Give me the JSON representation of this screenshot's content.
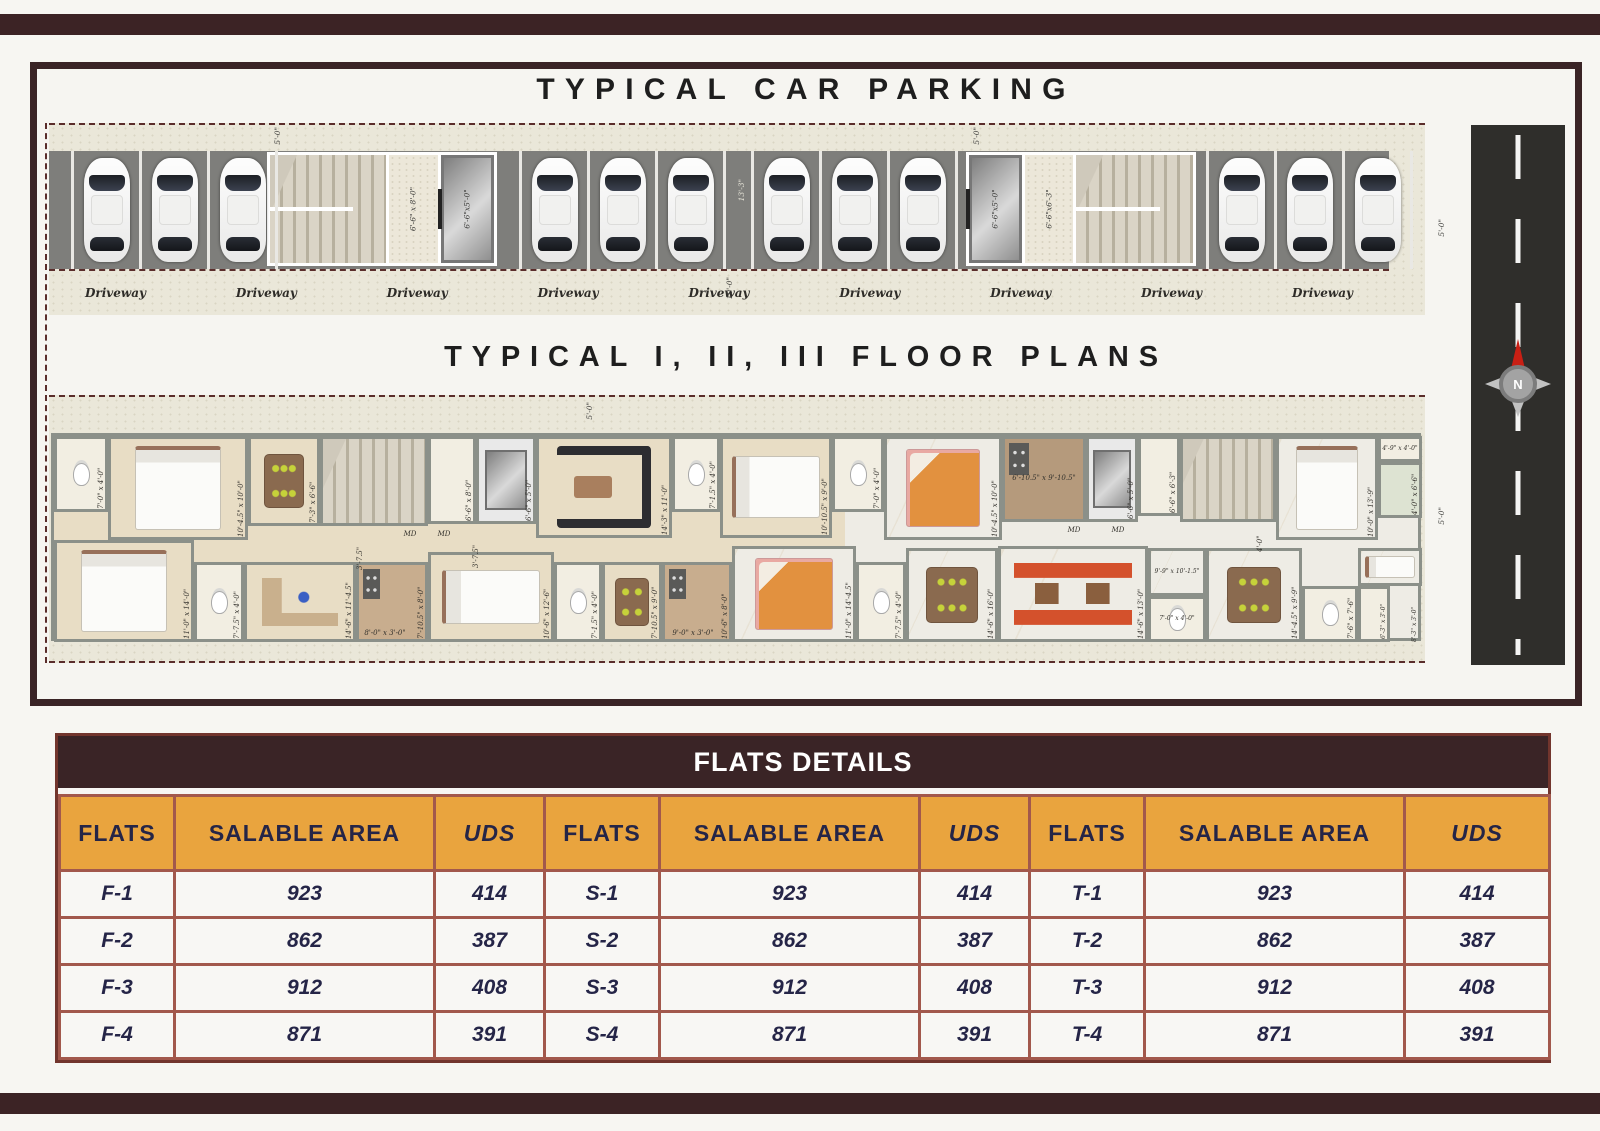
{
  "sheet": {
    "parking_title": "TYPICAL CAR PARKING",
    "floors_title": "TYPICAL I, II, III FLOOR PLANS"
  },
  "parking": {
    "driveway_labels": [
      "Driveway",
      "Driveway",
      "Driveway",
      "Driveway",
      "Driveway",
      "Driveway",
      "Driveway",
      "Driveway",
      "Driveway"
    ],
    "car_groups": [
      3,
      3,
      3,
      3
    ],
    "gap_dim": "13'-3\"",
    "driveway_dim": "10'-0\"",
    "side_dim": "5'-0\"",
    "block_a": {
      "top_dim": "5'-0\"",
      "lobby": "6'-6\" x 8'-0\"",
      "lift": "6'-6\"x5'-0\""
    },
    "block_b": {
      "top_dim": "5'-0\"",
      "lobby": "6'-6\"x6'-3\"",
      "lift": "6'-6\"x5'-0\""
    }
  },
  "floorplan": {
    "top_dim": "5'-0\"",
    "side_dim": "5'-0\"",
    "rooms": [
      {
        "n": "bath",
        "l": "7'-0\" x 4'-0\"",
        "x": 0,
        "y": 0,
        "w": 54,
        "h": 76,
        "r": 1,
        "f": "wc",
        "b": "bath"
      },
      {
        "n": "bedroom",
        "l": "10'-4.5\" x 10'-0\"",
        "x": 54,
        "y": 0,
        "w": 140,
        "h": 104,
        "r": 1,
        "f": "bedv",
        "b": "wood"
      },
      {
        "n": "dining",
        "l": "7'-3\" x 6'-6\"",
        "x": 194,
        "y": 0,
        "w": 72,
        "h": 90,
        "r": 1,
        "f": "table6",
        "b": "wood"
      },
      {
        "n": "staircase",
        "x": 266,
        "y": 0,
        "w": 108,
        "h": 90,
        "f": "stair",
        "b": "stair"
      },
      {
        "n": "lift-lobby",
        "l": "6'-6\" x 8'-0\"",
        "x": 374,
        "y": 0,
        "w": 48,
        "h": 88,
        "r": 1,
        "b": "bath"
      },
      {
        "n": "lift",
        "l": "6'-6\" x 5'-0\"",
        "x": 422,
        "y": 0,
        "w": 60,
        "h": 88,
        "r": 1,
        "f": "lift",
        "b": "lift"
      },
      {
        "n": "living",
        "l": "14'-3\" x 11'-0\"",
        "x": 482,
        "y": 0,
        "w": 136,
        "h": 102,
        "r": 1,
        "f": "sofad",
        "b": "wood"
      },
      {
        "n": "bath",
        "l": "7'-1.5\" x 4'-0\"",
        "x": 618,
        "y": 0,
        "w": 48,
        "h": 76,
        "r": 1,
        "f": "wc",
        "b": "bath"
      },
      {
        "n": "bedroom",
        "l": "10'-10.5\" x 9'-0\"",
        "x": 666,
        "y": 0,
        "w": 112,
        "h": 102,
        "r": 1,
        "f": "bedh",
        "b": "wood"
      },
      {
        "n": "bath",
        "l": "7'-0\" x 4'-0\"",
        "x": 778,
        "y": 0,
        "w": 52,
        "h": 76,
        "r": 1,
        "f": "wc",
        "b": "bath"
      },
      {
        "n": "bedroom",
        "l": "10'-4.5\" x 10'-0\"",
        "x": 830,
        "y": 0,
        "w": 118,
        "h": 104,
        "r": 1,
        "f": "bedov",
        "b": "marble"
      },
      {
        "n": "kitchen",
        "l": "6'-10.5\" x 9'-10.5\"",
        "x": 948,
        "y": 0,
        "w": 84,
        "h": 86,
        "f": "kitchen",
        "b": "kitchen"
      },
      {
        "n": "lift",
        "l": "6'-6\" x 5'-0\"",
        "x": 1032,
        "y": 0,
        "w": 52,
        "h": 86,
        "r": 1,
        "f": "lift",
        "b": "lift"
      },
      {
        "n": "lift-lobby",
        "l": "6'-6\" x 6'-3\"",
        "x": 1084,
        "y": 0,
        "w": 42,
        "h": 80,
        "r": 1,
        "b": "bath"
      },
      {
        "n": "staircase",
        "x": 1126,
        "y": 0,
        "w": 96,
        "h": 86,
        "f": "stair",
        "b": "stair"
      },
      {
        "n": "bedroom",
        "l": "10'-0\" x 13'-9\"",
        "x": 1222,
        "y": 0,
        "w": 102,
        "h": 104,
        "r": 1,
        "f": "bedv",
        "b": "marble"
      },
      {
        "n": "duct",
        "l": "4'-9\" x 4'-0\"",
        "x": 1324,
        "y": 0,
        "w": 44,
        "h": 26,
        "s": 1,
        "b": "bath"
      },
      {
        "n": "balcony",
        "l": "4'-0\" x 6'-6\"",
        "x": 1324,
        "y": 26,
        "w": 44,
        "h": 56,
        "r": 1,
        "b": "balc"
      },
      {
        "n": "bedroom",
        "l": "11'-0\" x 14'-0\"",
        "x": 0,
        "y": 104,
        "w": 140,
        "h": 102,
        "r": 1,
        "f": "bedv",
        "b": "wood"
      },
      {
        "n": "bath",
        "l": "7'-7.5\" x 4'-0\"",
        "x": 140,
        "y": 126,
        "w": 50,
        "h": 80,
        "r": 1,
        "f": "wc",
        "b": "bath"
      },
      {
        "n": "study",
        "l": "14'-6\" x 11'-4.5\"",
        "x": 190,
        "y": 126,
        "w": 112,
        "h": 80,
        "r": 1,
        "f": "desk",
        "b": "wood"
      },
      {
        "n": "kitchen",
        "l": "7'-10.5\" x 8'-0\"",
        "x": 302,
        "y": 126,
        "w": 72,
        "h": 80,
        "r": 1,
        "f": "kitchen",
        "b": "kitchen2"
      },
      {
        "n": "bedroom",
        "l": "10'-6\" x 12'-6\"",
        "x": 374,
        "y": 116,
        "w": 126,
        "h": 90,
        "r": 1,
        "f": "bedh",
        "b": "wood"
      },
      {
        "n": "bath",
        "l": "7'-1.5\" x 4'-0\"",
        "x": 500,
        "y": 126,
        "w": 48,
        "h": 80,
        "r": 1,
        "f": "wc",
        "b": "bath"
      },
      {
        "n": "dining",
        "l": "7'-10.5\" x 9'-0\"",
        "x": 548,
        "y": 126,
        "w": 60,
        "h": 80,
        "r": 1,
        "f": "table4",
        "b": "wood"
      },
      {
        "n": "kitchen",
        "l": "10'-6\" x 8'-0\"",
        "x": 608,
        "y": 126,
        "w": 70,
        "h": 80,
        "r": 1,
        "f": "kitchen",
        "b": "kitchen2"
      },
      {
        "n": "bedroom",
        "l": "11'-0\" x 14'-4.5\"",
        "x": 678,
        "y": 110,
        "w": 124,
        "h": 96,
        "r": 1,
        "f": "bedov",
        "b": "marble"
      },
      {
        "n": "bath",
        "l": "7'-7.5\" x 4'-0\"",
        "x": 802,
        "y": 126,
        "w": 50,
        "h": 80,
        "r": 1,
        "f": "wc",
        "b": "bath"
      },
      {
        "n": "dining",
        "l": "14'-6\" x 16'-0\"",
        "x": 852,
        "y": 112,
        "w": 92,
        "h": 94,
        "r": 1,
        "f": "table6",
        "b": "marble"
      },
      {
        "n": "living",
        "l": "14'-6\" x 13'-0\"",
        "x": 944,
        "y": 110,
        "w": 150,
        "h": 96,
        "r": 1,
        "f": "sofao",
        "b": "marble"
      },
      {
        "n": "hall",
        "l": "9'-9\" x 10'-1.5\"",
        "x": 1094,
        "y": 112,
        "w": 58,
        "h": 48,
        "s": 1,
        "b": "marble"
      },
      {
        "n": "bath",
        "l": "7'-0\" x 4'-0\"",
        "x": 1094,
        "y": 160,
        "w": 58,
        "h": 46,
        "s": 1,
        "f": "wc",
        "b": "bath"
      },
      {
        "n": "dining",
        "l": "14'-4.5\" x 9'-9\"",
        "x": 1152,
        "y": 112,
        "w": 96,
        "h": 94,
        "r": 1,
        "f": "table6",
        "b": "marble"
      },
      {
        "n": "bath",
        "l": "7'-6\" x 7'-6\"",
        "x": 1248,
        "y": 150,
        "w": 56,
        "h": 56,
        "r": 1,
        "f": "wc",
        "b": "bath"
      },
      {
        "n": "utility",
        "l": "6'-3\" x 3'-0\"",
        "x": 1304,
        "y": 150,
        "w": 32,
        "h": 56,
        "r": 1,
        "s": 1,
        "b": "bath"
      },
      {
        "n": "bedroom",
        "x": 1304,
        "y": 112,
        "w": 64,
        "h": 38,
        "f": "bedh",
        "b": "marble"
      },
      {
        "n": "dim-label",
        "l": "8'-3\" x 3'-0\"",
        "x": 1340,
        "y": 150,
        "w": 24,
        "h": 56,
        "r": 1,
        "s": 1,
        "plain": 1
      },
      {
        "n": "main-door-label",
        "l": "MD",
        "x": 344,
        "y": 92,
        "w": 24,
        "h": 14,
        "plain": 1
      },
      {
        "n": "main-door-label",
        "l": "MD",
        "x": 378,
        "y": 92,
        "w": 24,
        "h": 14,
        "plain": 1
      },
      {
        "n": "main-door-label",
        "l": "MD",
        "x": 1008,
        "y": 88,
        "w": 24,
        "h": 14,
        "plain": 1
      },
      {
        "n": "main-door-label",
        "l": "MD",
        "x": 1052,
        "y": 88,
        "w": 24,
        "h": 14,
        "plain": 1
      },
      {
        "n": "dim-label",
        "l": "3'-7.5\"",
        "x": 296,
        "y": 92,
        "w": 14,
        "h": 42,
        "r": 1,
        "plain": 1
      },
      {
        "n": "dim-label",
        "l": "3'-7.5\"",
        "x": 412,
        "y": 90,
        "w": 14,
        "h": 42,
        "r": 1,
        "plain": 1
      },
      {
        "n": "dim-label",
        "l": "4'-0\"",
        "x": 1196,
        "y": 86,
        "w": 14,
        "h": 30,
        "r": 1,
        "plain": 1
      },
      {
        "n": "dim-label",
        "l": "9'-0\" x 3'-0\"",
        "x": 604,
        "y": 191,
        "w": 70,
        "h": 14,
        "plain": 1
      },
      {
        "n": "dim-label",
        "l": "8'-0\" x 3'-0\"",
        "x": 296,
        "y": 191,
        "w": 70,
        "h": 14,
        "plain": 1
      }
    ]
  },
  "road": {
    "compass_label": "N"
  },
  "flats_table": {
    "title": "FLATS DETAILS",
    "columns": [
      "FLATS",
      "SALABLE AREA",
      "UDS",
      "FLATS",
      "SALABLE AREA",
      "UDS",
      "FLATS",
      "SALABLE AREA",
      "UDS"
    ],
    "rows": [
      [
        "F-1",
        "923",
        "414",
        "S-1",
        "923",
        "414",
        "T-1",
        "923",
        "414"
      ],
      [
        "F-2",
        "862",
        "387",
        "S-2",
        "862",
        "387",
        "T-2",
        "862",
        "387"
      ],
      [
        "F-3",
        "912",
        "408",
        "S-3",
        "912",
        "408",
        "T-3",
        "912",
        "408"
      ],
      [
        "F-4",
        "871",
        "391",
        "S-4",
        "871",
        "391",
        "T-4",
        "871",
        "391"
      ]
    ]
  }
}
